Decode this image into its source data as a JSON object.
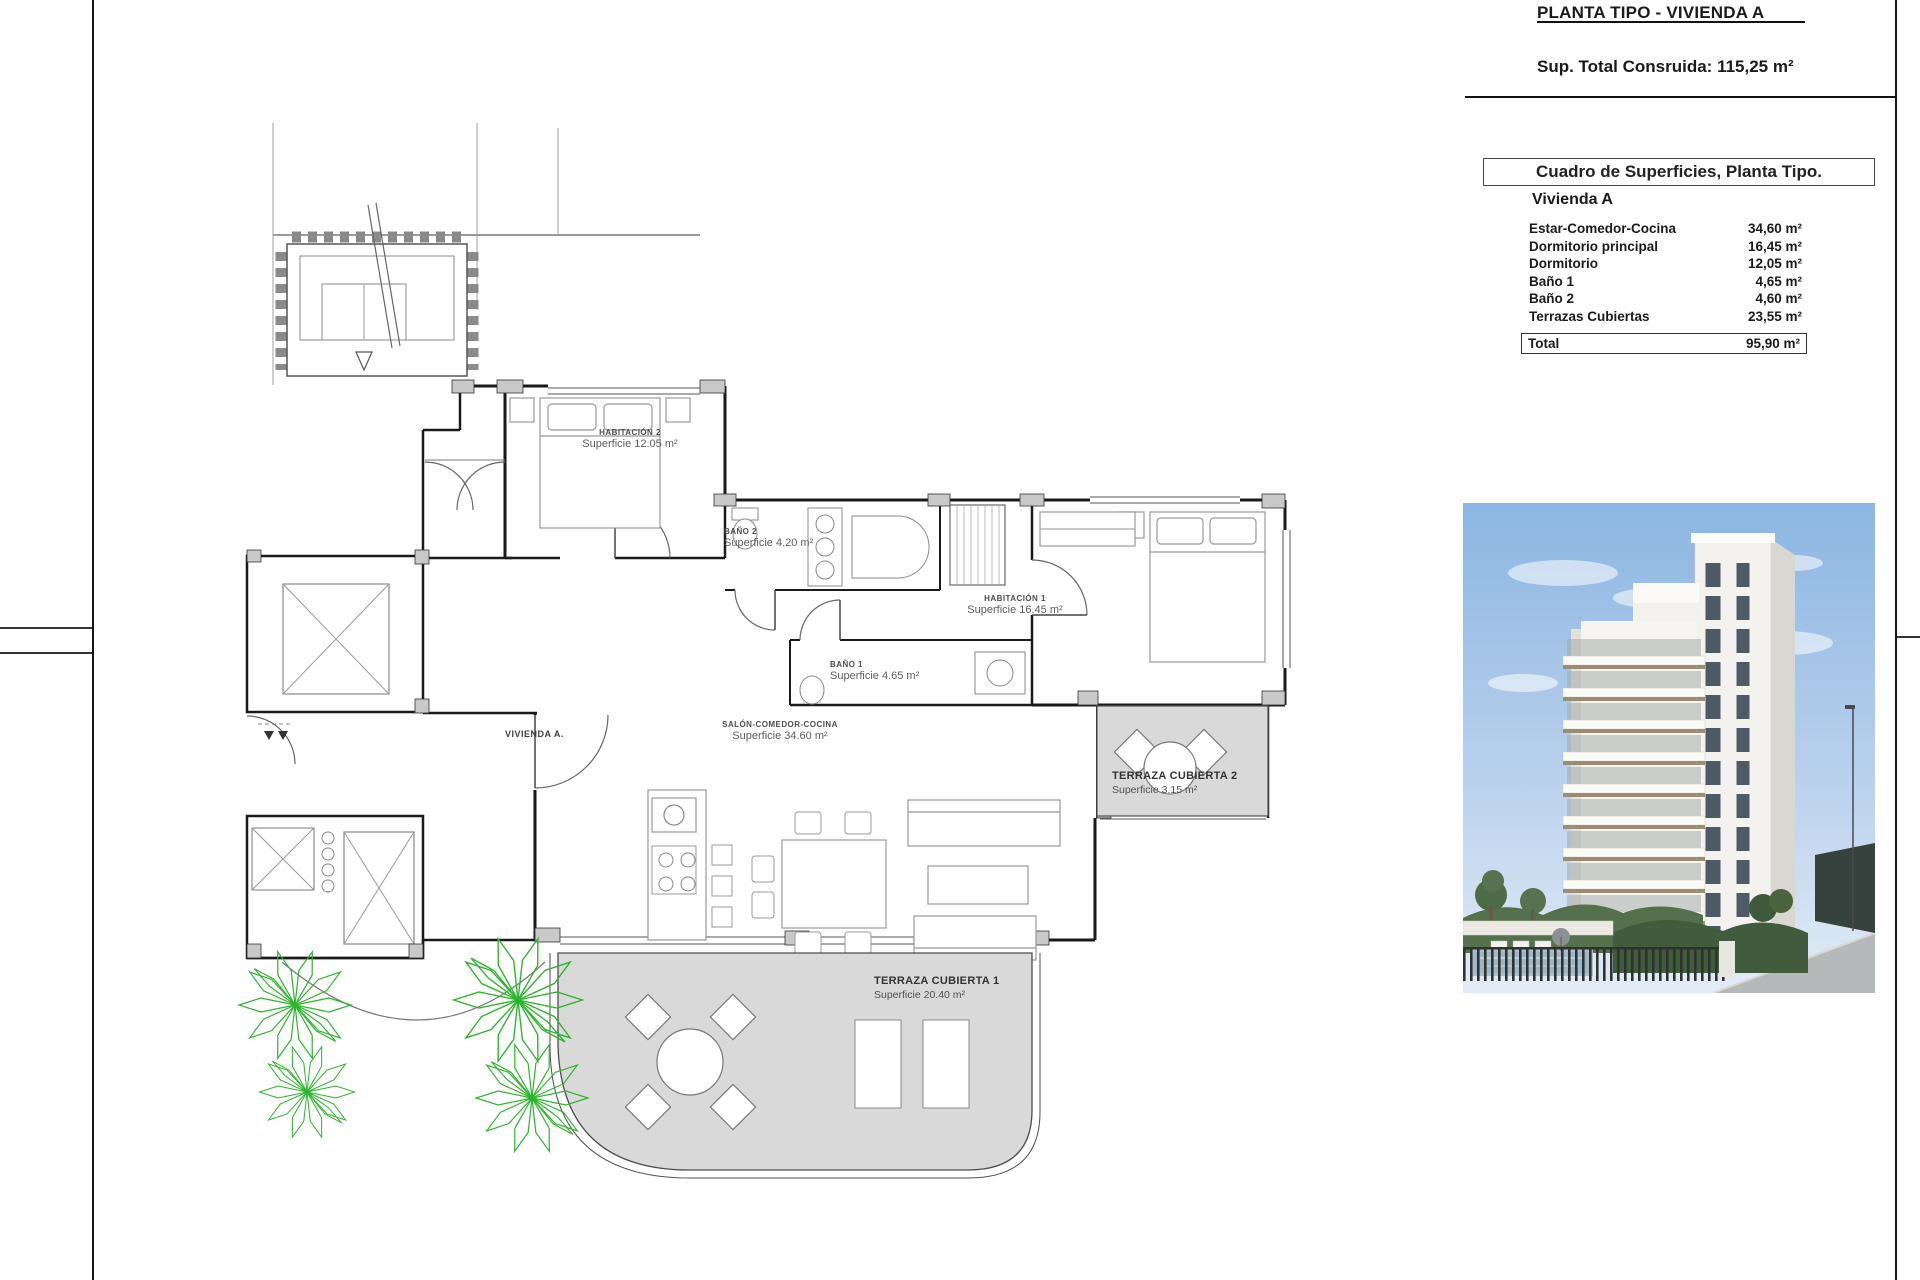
{
  "page": {
    "sheet_title": "PLANTA TIPO - VIVIENDA A",
    "total_built_area": "Sup. Total Consruida: 115,25 m²"
  },
  "surface_table": {
    "header": "Cuadro de Superficies, Planta Tipo.",
    "unit_name": "Vivienda A",
    "rows": [
      {
        "label": "Estar-Comedor-Cocina",
        "value": "34,60 m²"
      },
      {
        "label": "Dormitorio principal",
        "value": "16,45 m²"
      },
      {
        "label": "Dormitorio",
        "value": "12,05 m²"
      },
      {
        "label": "Baño 1",
        "value": "4,65 m²"
      },
      {
        "label": "Baño 2",
        "value": "4,60 m²"
      },
      {
        "label": "Terrazas Cubiertas",
        "value": "23,55 m²"
      }
    ],
    "total_label": "Total",
    "total_value": "95,90 m²"
  },
  "floor_plan": {
    "unit_tag": "VIVIENDA A.",
    "habitacion2": {
      "name": "HABITACIÓN 2",
      "area": "Superficie 12.05 m²"
    },
    "bano2": {
      "name": "BAÑO 2",
      "area": "Superficie 4.20 m²"
    },
    "habitacion1": {
      "name": "HABITACIÓN 1",
      "area": "Superficie 16.45 m²"
    },
    "bano1": {
      "name": "BAÑO 1",
      "area": "Superficie 4.65 m²"
    },
    "salon": {
      "name": "SALÓN-COMEDOR-COCINA",
      "area": "Superficie 34.60 m²"
    },
    "terraza2": {
      "name": "TERRAZA CUBIERTA 2",
      "area": "Superficie 3.15 m²"
    },
    "terraza1": {
      "name": "TERRAZA CUBIERTA 1",
      "area": "Superficie 20.40 m²"
    }
  },
  "colors": {
    "wall": "#1a1a1a",
    "terrace_fill": "#d9d9d9",
    "plant_green": "#2db52d",
    "sky_top": "#8cb6e2",
    "sky_bottom": "#e3ecf6"
  }
}
